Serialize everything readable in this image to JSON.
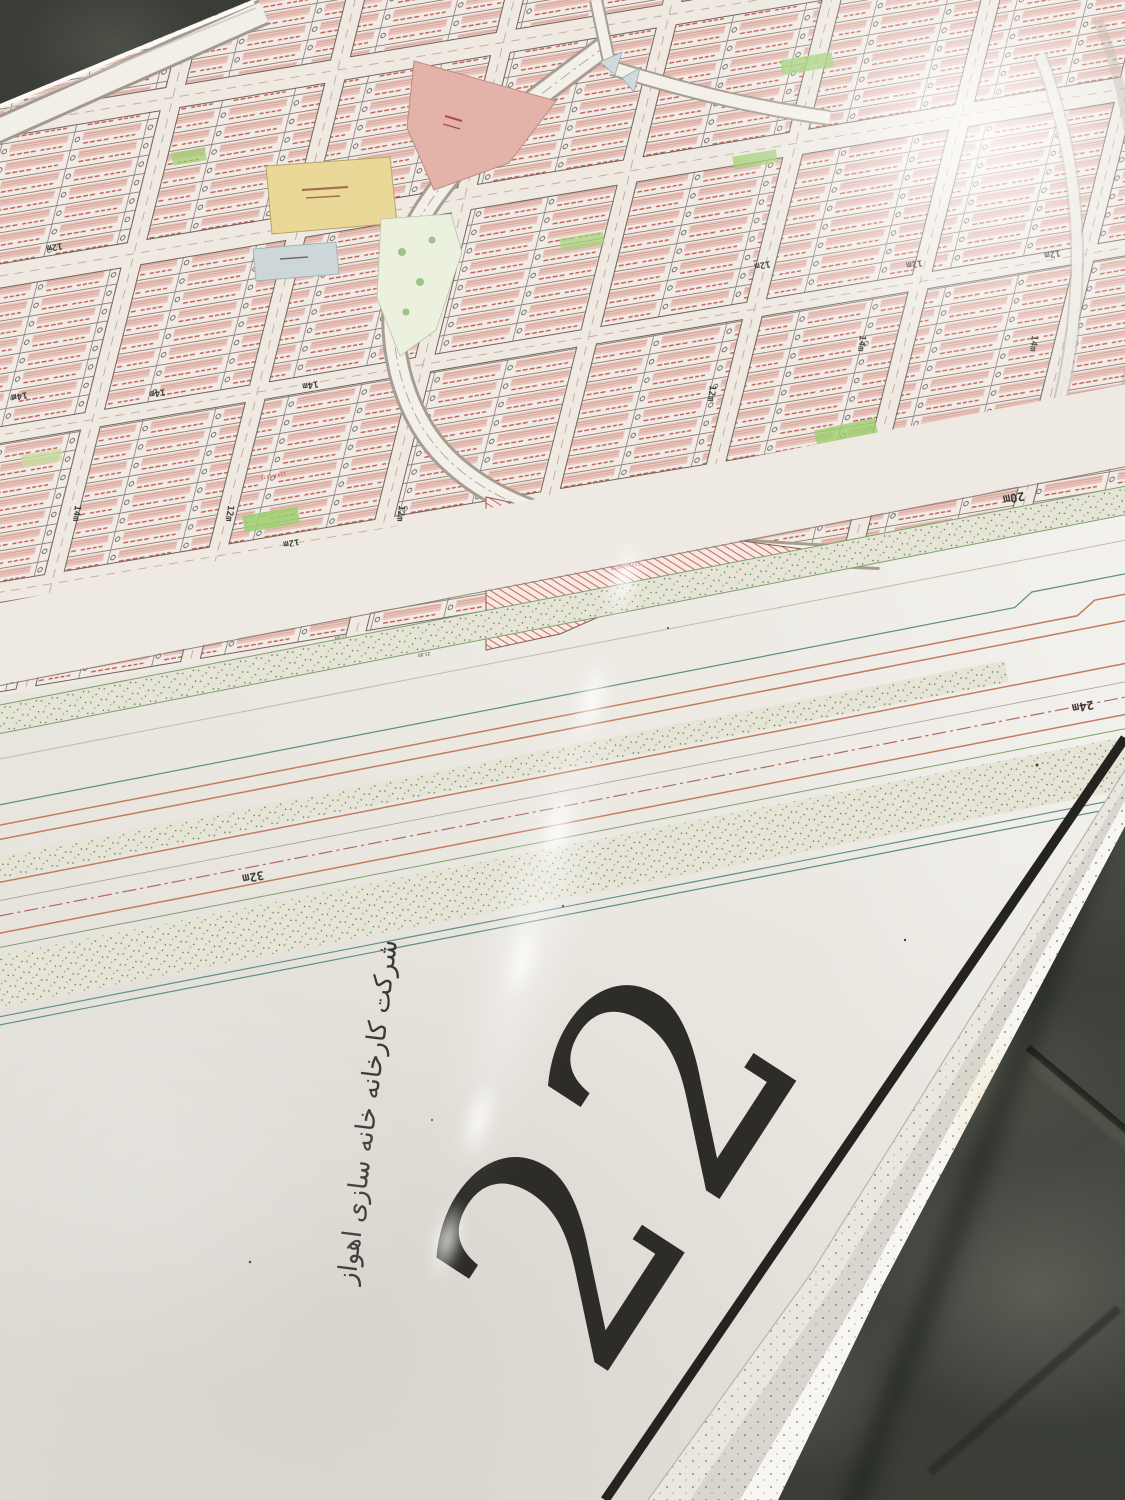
{
  "sheet": {
    "number": "22",
    "company_caption": "شرکت کارخانه خانه سازی اهواز"
  },
  "map": {
    "street_labels": {
      "w32": "32m",
      "w24": "24m",
      "w20": "20m",
      "w14": "14m",
      "w12": "12m"
    },
    "plot_samples": [
      "1140F1283",
      "G1276AA3762",
      "1140F1280",
      "G1274AA4191",
      "1140F1288",
      "G1275AA4239.96",
      "1140F1279",
      "G1371 AA293.92",
      "1140F1316",
      "1139AA4018",
      "1140F1375",
      "G1356AA3573"
    ],
    "dimension_samples": [
      "24.00",
      "27.00",
      "14.00",
      "21.00"
    ],
    "colors": {
      "plot_fill": "#e7c4bc",
      "hatch_red": "#c0544a",
      "annotation_red": "#c14a42",
      "green_space": "#9ccf6f",
      "public_yellow": "#ead898",
      "reserve_salmon": "#e3b2a8",
      "blue_block": "#cdd7da",
      "corridor_orange": "#c47a5c",
      "corridor_teal": "#5e8f80",
      "border_black": "#24231f"
    }
  }
}
